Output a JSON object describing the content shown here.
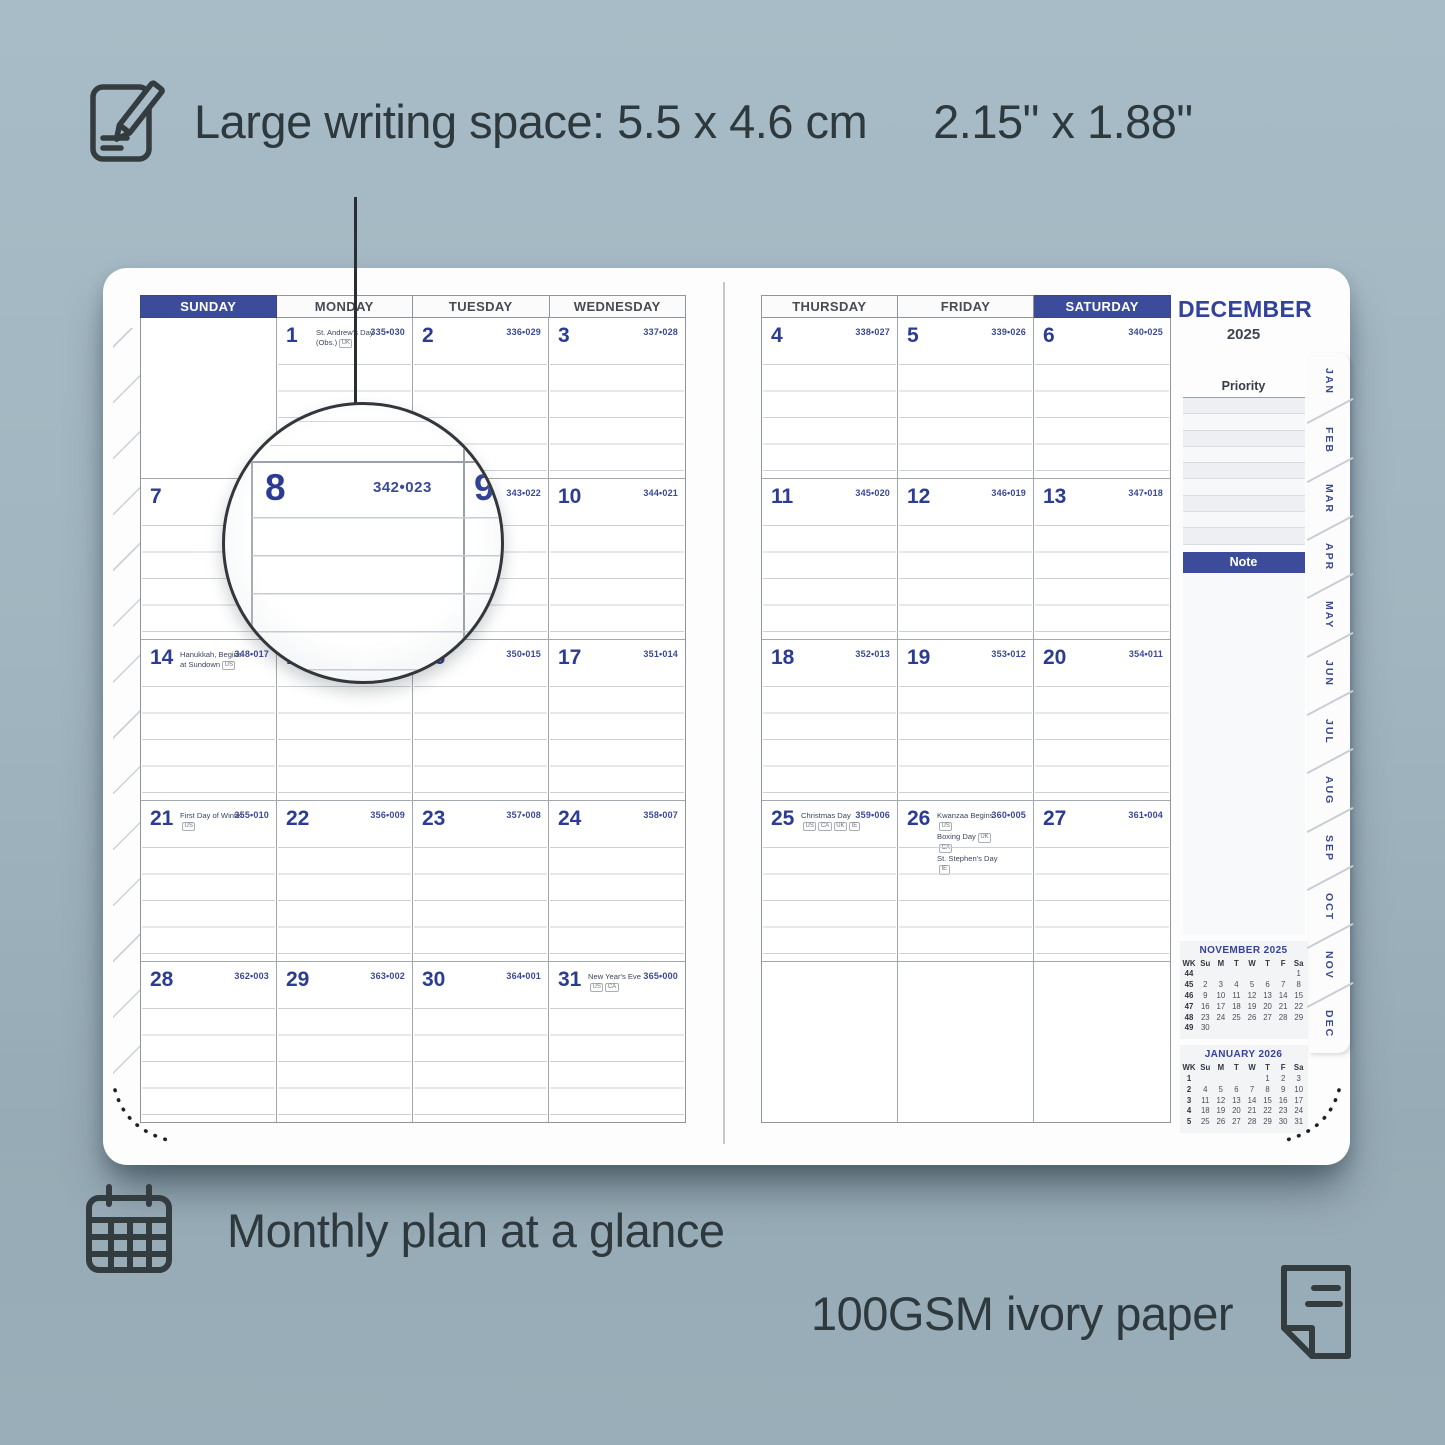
{
  "colors": {
    "accent_navy": "#3c4c9b",
    "background": "#a1b5c0",
    "text_dark": "#2e393d"
  },
  "callouts": {
    "writing_space_metric": "Large writing space: 5.5 x 4.6 cm",
    "writing_space_imperial": "2.15\" x 1.88\"",
    "monthly_plan": "Monthly plan at a glance",
    "paper": "100GSM ivory paper"
  },
  "planner": {
    "month": "DECEMBER",
    "year": "2025",
    "magnifier": {
      "day": "8",
      "julian": "342•023",
      "next_day": "9"
    },
    "left_page": {
      "headers": [
        {
          "label": "SUNDAY",
          "highlight": true
        },
        {
          "label": "MONDAY",
          "highlight": false
        },
        {
          "label": "TUESDAY",
          "highlight": false
        },
        {
          "label": "WEDNESDAY",
          "highlight": false
        }
      ],
      "rows": [
        [
          {
            "day": ""
          },
          {
            "day": "1",
            "julian": "335•030",
            "holidays": [
              {
                "text": "St. Andrew's Day (Obs.)",
                "badges": [
                  "UK"
                ]
              }
            ]
          },
          {
            "day": "2",
            "julian": "336•029"
          },
          {
            "day": "3",
            "julian": "337•028"
          }
        ],
        [
          {
            "day": "7",
            "julian": ""
          },
          {
            "day": "8",
            "julian": ""
          },
          {
            "day": "9",
            "julian": "343•022"
          },
          {
            "day": "10",
            "julian": "344•021"
          }
        ],
        [
          {
            "day": "14",
            "julian": "348•017",
            "holidays": [
              {
                "text": "Hanukkah, Begins at Sundown",
                "badges": [
                  "US"
                ]
              }
            ]
          },
          {
            "day": "15",
            "julian": ""
          },
          {
            "day": "16",
            "julian": "350•015"
          },
          {
            "day": "17",
            "julian": "351•014"
          }
        ],
        [
          {
            "day": "21",
            "julian": "355•010",
            "holidays": [
              {
                "text": "First Day of Winter",
                "badges": [
                  "US"
                ]
              }
            ]
          },
          {
            "day": "22",
            "julian": "356•009"
          },
          {
            "day": "23",
            "julian": "357•008"
          },
          {
            "day": "24",
            "julian": "358•007"
          }
        ],
        [
          {
            "day": "28",
            "julian": "362•003"
          },
          {
            "day": "29",
            "julian": "363•002"
          },
          {
            "day": "30",
            "julian": "364•001"
          },
          {
            "day": "31",
            "julian": "365•000",
            "holidays": [
              {
                "text": "New Year's Eve",
                "badges": [
                  "US",
                  "CA"
                ]
              }
            ]
          }
        ]
      ]
    },
    "right_page": {
      "headers": [
        {
          "label": "THURSDAY",
          "highlight": false
        },
        {
          "label": "FRIDAY",
          "highlight": false
        },
        {
          "label": "SATURDAY",
          "highlight": true
        }
      ],
      "rows": [
        [
          {
            "day": "4",
            "julian": "338•027"
          },
          {
            "day": "5",
            "julian": "339•026"
          },
          {
            "day": "6",
            "julian": "340•025"
          }
        ],
        [
          {
            "day": "11",
            "julian": "345•020"
          },
          {
            "day": "12",
            "julian": "346•019"
          },
          {
            "day": "13",
            "julian": "347•018"
          }
        ],
        [
          {
            "day": "18",
            "julian": "352•013"
          },
          {
            "day": "19",
            "julian": "353•012"
          },
          {
            "day": "20",
            "julian": "354•011"
          }
        ],
        [
          {
            "day": "25",
            "julian": "359•006",
            "holidays": [
              {
                "text": "Christmas Day",
                "badges": [
                  "US",
                  "CA",
                  "UK",
                  "IE"
                ]
              }
            ]
          },
          {
            "day": "26",
            "julian": "360•005",
            "holidays": [
              {
                "text": "Kwanzaa Begins",
                "badges": [
                  "US"
                ]
              },
              {
                "text": "Boxing Day",
                "badges": [
                  "UK",
                  "CA"
                ]
              },
              {
                "text": "St. Stephen's Day",
                "badges": [
                  "IE"
                ]
              }
            ]
          },
          {
            "day": "27",
            "julian": "361•004"
          }
        ],
        [
          {
            "day": ""
          },
          {
            "day": ""
          },
          {
            "day": ""
          }
        ]
      ]
    },
    "sidebar": {
      "priority_label": "Priority",
      "note_label": "Note",
      "mini_calendars": [
        {
          "title": "NOVEMBER  2025",
          "headers": [
            "WK",
            "Su",
            "M",
            "T",
            "W",
            "T",
            "F",
            "Sa"
          ],
          "rows": [
            [
              "44",
              "",
              "",
              "",
              "",
              "",
              "",
              "1"
            ],
            [
              "45",
              "2",
              "3",
              "4",
              "5",
              "6",
              "7",
              "8"
            ],
            [
              "46",
              "9",
              "10",
              "11",
              "12",
              "13",
              "14",
              "15"
            ],
            [
              "47",
              "16",
              "17",
              "18",
              "19",
              "20",
              "21",
              "22"
            ],
            [
              "48",
              "23",
              "24",
              "25",
              "26",
              "27",
              "28",
              "29"
            ],
            [
              "49",
              "30",
              "",
              "",
              "",
              "",
              "",
              ""
            ]
          ]
        },
        {
          "title": "JANUARY  2026",
          "headers": [
            "WK",
            "Su",
            "M",
            "T",
            "W",
            "T",
            "F",
            "Sa"
          ],
          "rows": [
            [
              "1",
              "",
              "",
              "",
              "",
              "1",
              "2",
              "3"
            ],
            [
              "2",
              "4",
              "5",
              "6",
              "7",
              "8",
              "9",
              "10"
            ],
            [
              "3",
              "11",
              "12",
              "13",
              "14",
              "15",
              "16",
              "17"
            ],
            [
              "4",
              "18",
              "19",
              "20",
              "21",
              "22",
              "23",
              "24"
            ],
            [
              "5",
              "25",
              "26",
              "27",
              "28",
              "29",
              "30",
              "31"
            ]
          ]
        }
      ],
      "month_tabs": [
        "JAN",
        "FEB",
        "MAR",
        "APR",
        "MAY",
        "JUN",
        "JUL",
        "AUG",
        "SEP",
        "OCT",
        "NOV",
        "DEC"
      ]
    }
  }
}
